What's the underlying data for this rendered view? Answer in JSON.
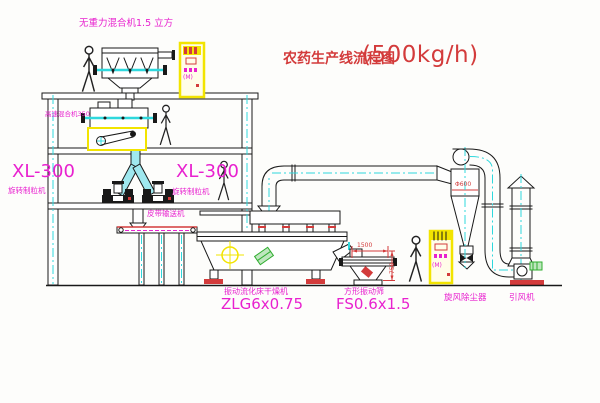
{
  "title": {
    "name": "农药生产线流程图",
    "capacity": "(500kg/h)"
  },
  "equipment_labels": {
    "gravity_free_mixer": "无重力混合机1.5 立方",
    "high_speed_mixer": "高速混合机350",
    "granulator_left": {
      "model": "XL-300",
      "name": "旋转制粒机"
    },
    "granulator_right": {
      "model": "XL-300",
      "name": "旋转制粒机"
    },
    "belt_conveyor": "皮带输送机",
    "fluid_bed_dryer": {
      "name": "振动流化床干燥机",
      "model": "ZLG6x0.75"
    },
    "square_sieve": {
      "name": "方形振动筛",
      "model": "FS0.6x1.5"
    },
    "cyclone_dust_collector": "旋风除尘器",
    "induced_draft_fan": "引风机"
  },
  "dimensions": {
    "cyclone_diameter": "Φ600",
    "sieve_length": "1500",
    "sieve_height": "750"
  },
  "control_cabinets": {
    "mark": "(M)"
  },
  "colors": {
    "line": "#191919",
    "centerline_cyan": "#2fd8dd",
    "highlight_yellow": "#f2e400",
    "label_magenta": "#e821cf",
    "title_red": "#d33b3b",
    "accent_green": "#2fae2f"
  }
}
